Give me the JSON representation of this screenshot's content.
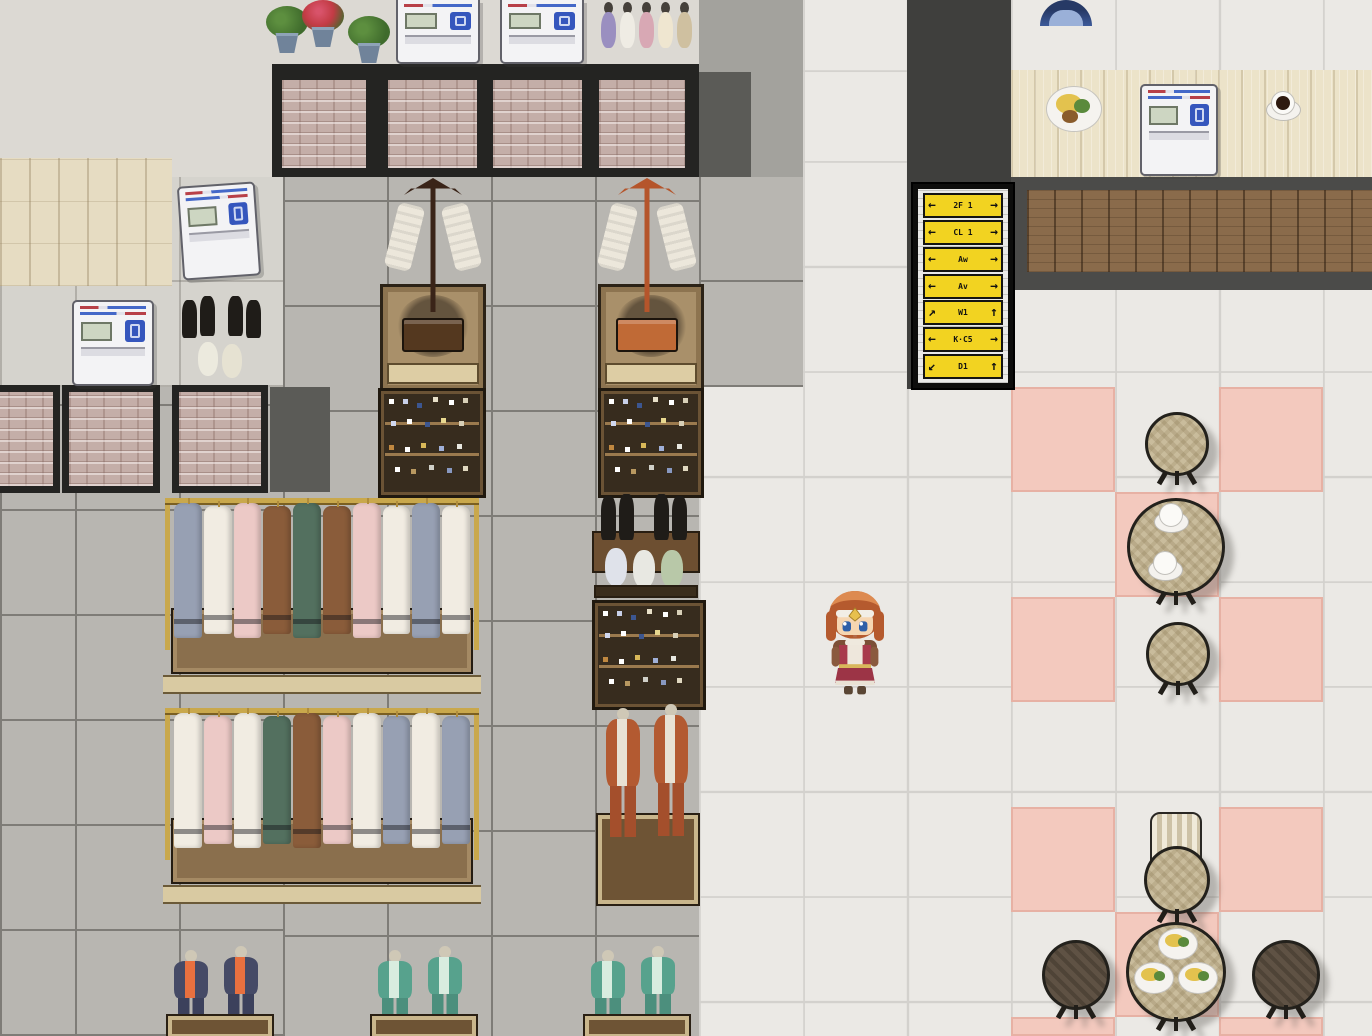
{
  "scene": {
    "type": "rpg-top-down-map",
    "setting": "Shopping mall interior: clothing and shoe shop on the left, corridor, directional sign, cafe seating area on the right",
    "player_visible": true
  },
  "palette": {
    "walkway": "#ebe9e5",
    "walkline": "#d3d1cd",
    "shopfloor": "#b8b6b1",
    "shopline": "#7e7c77",
    "wall": "#dcd9d3",
    "charcoal": "#3f3f3d",
    "darktile": "#5b5b57",
    "brick": "#c4aea8",
    "frame": "#242422",
    "woodlight": "#ece3c9",
    "wooddark": "#8a6b4b",
    "band": "#4b4b49",
    "pink": "#f3c9be",
    "signyellow": "#f2d321",
    "tablewood": "#c9bc9c",
    "tabledark": "#5f5244",
    "gold": "#c9a84c",
    "rackbase": "#8a6f4d",
    "vendblue": "#3556bd"
  },
  "sign": {
    "rows": [
      {
        "left": "←",
        "label": "2F 1",
        "right": "→"
      },
      {
        "left": "←",
        "label": "CL 1",
        "right": "→"
      },
      {
        "left": "←",
        "label": "Aw",
        "right": "→"
      },
      {
        "left": "←",
        "label": "Av",
        "right": "→"
      },
      {
        "left": "↗",
        "label": "W1",
        "right": "↑"
      },
      {
        "left": "←",
        "label": "K·C5",
        "right": "→"
      },
      {
        "left": "↙",
        "label": "D1",
        "right": "↑"
      }
    ]
  },
  "inventory": {
    "vending_machines": 5,
    "brick_wall_panels_top": 4,
    "brick_wall_panels_left": 3,
    "clothing_racks": 2,
    "display_pedestals": 2,
    "shoe_shelves": 3,
    "boot_displays": 2,
    "mannequin_pairs": 4,
    "mannequin_busts": 5,
    "cafe_round_tables": 7,
    "cafe_chairs": 1,
    "coffee_cups": 3,
    "food_plates": 4,
    "flower_pots": 3,
    "directional_sign_rows": 7
  }
}
